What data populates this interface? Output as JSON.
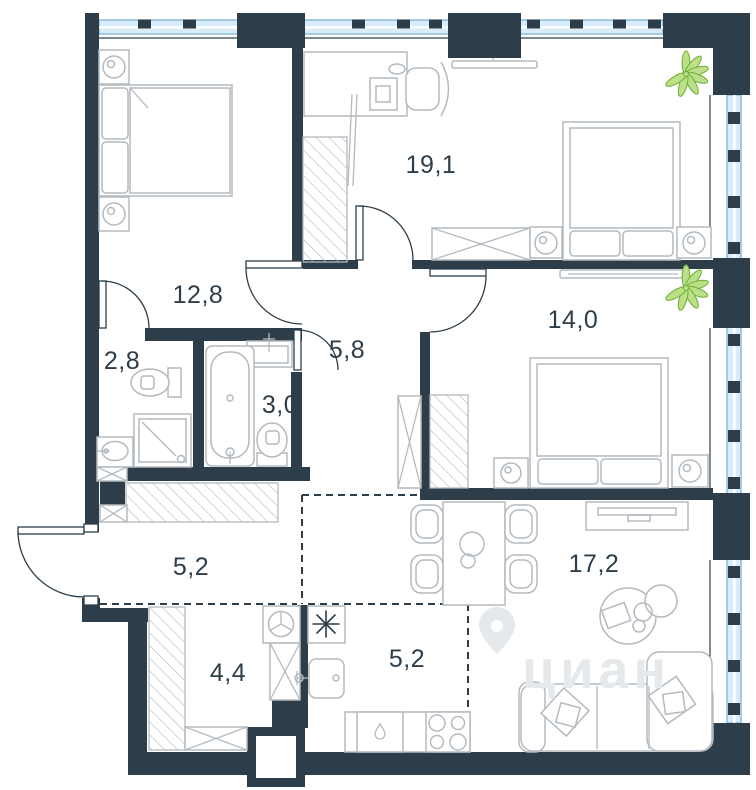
{
  "plan_title": "apartment-floor-plan",
  "watermark": {
    "brand": "циан"
  },
  "rooms": [
    {
      "name": "bedroom-top-right",
      "area_m2": "19,1"
    },
    {
      "name": "bedroom-top-left",
      "area_m2": "12,8"
    },
    {
      "name": "wc-left",
      "area_m2": "2,8"
    },
    {
      "name": "hallway-center",
      "area_m2": "5,8"
    },
    {
      "name": "bathroom-center",
      "area_m2": "3,0"
    },
    {
      "name": "bedroom-right",
      "area_m2": "14,0"
    },
    {
      "name": "corridor",
      "area_m2": "5,2"
    },
    {
      "name": "storage-laundry",
      "area_m2": "4,4"
    },
    {
      "name": "kitchen",
      "area_m2": "5,2"
    },
    {
      "name": "living-room",
      "area_m2": "17,2"
    }
  ],
  "icons": {
    "fixtures": [
      "double-bed",
      "nightstand-lamp",
      "wardrobe",
      "desk-computer",
      "office-chair",
      "mirror",
      "tv",
      "toilet",
      "bathtub",
      "shower-cabin",
      "washbasin",
      "washing-machine",
      "kitchen-sink",
      "stove-4-burners",
      "dishwasher",
      "dining-table",
      "chair",
      "sofa-corner",
      "coffee-table",
      "plant",
      "door-swing",
      "window",
      "vent-shaft",
      "watermark-pin"
    ]
  },
  "colors": {
    "wall": "#2d3e4a",
    "window_fill": "#d8edf9",
    "window_stroke": "#74aed3",
    "furniture": "#b3bac0",
    "plant": "#74b23c",
    "watermark": "#e6e9ec",
    "background": "#ffffff"
  }
}
